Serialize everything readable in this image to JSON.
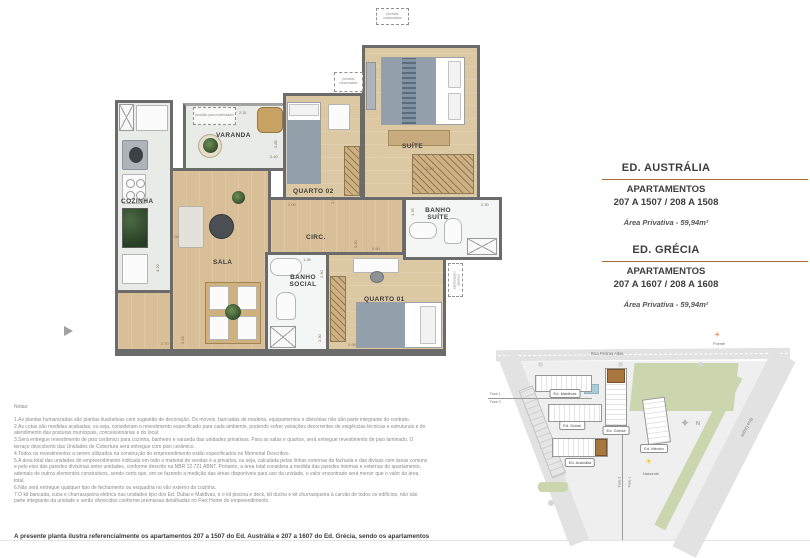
{
  "panel": {
    "sections": [
      {
        "building": "ED. AUSTRÁLIA",
        "apts_label": "APARTAMENTOS",
        "apts_range": "207 A 1507 / 208 A 1508",
        "area": "Área Privativa - 59,94m²"
      },
      {
        "building": "ED. GRÉCIA",
        "apts_label": "APARTAMENTOS",
        "apts_range": "207 A 1607 / 208 A 1608",
        "area": "Área Privativa - 59,94m²"
      }
    ]
  },
  "plan": {
    "rooms": {
      "cozinha": "COZINHA",
      "varanda": "VARANDA",
      "quarto02": "QUARTO 02",
      "suite": "SUÍTE",
      "circ": "CIRC.",
      "sala": "SALA",
      "banho_social": "BANHO SOCIAL",
      "quarto01": "QUARTO 01",
      "banho_suite": "BANHO SUÍTE"
    },
    "condenser_long": "previsão para condensador",
    "condenser_short": "previsão condensador",
    "dims": {
      "varanda_top": "2.31",
      "varanda_right": "0.85",
      "varanda_bottom": "2.40",
      "cozinha_top": "1.50",
      "cozinha_left": "4.20",
      "sala_bottom": "2.70",
      "sala_left": "5.93",
      "quarto02_bottom": "2.00",
      "quarto02_right": "2.95",
      "suite_bottom": "2.40",
      "circ_a": "0.90",
      "circ_b": "0.90",
      "banho_social_top": "1.35",
      "banho_social_right": "2.30",
      "banho_social_bottom": "2.30",
      "quarto01_bottom": "2.95",
      "banho_suite_left": "1.35",
      "banho_suite_top": "2.30"
    }
  },
  "siteplan": {
    "street_top": "Rua Pedras Altas",
    "street_left": "Av. Dom Helder Câmara",
    "street_right": "Rua Degas",
    "buildings": {
      "maldivas": "Ed. Maldivas",
      "dubai": "Ed. Dubai",
      "grecia": "Ed. Grécia",
      "mexico": "Ed. México",
      "australia": "Ed. Austrália"
    },
    "compass": "N",
    "sun_east_label": "Nascente",
    "sun_west_label": "Poente",
    "phase1": "Fase 1",
    "phase2": "Fase 2",
    "colors": {
      "highlight": "#a8763f",
      "green": "#ccd6ae",
      "rule_brown": "#a86a38",
      "sun_east": "#f2c71d",
      "sun_west": "#e2803a"
    }
  },
  "notes": {
    "title": "Notas:",
    "items": [
      "1.As plantas humanizadas são plantas ilustrativas com sugestão de decoração. Os móveis, bancadas de madeira, equipamentos e divisórias não são parte integrante do contrato.",
      "2.As cotas são medidas acabadas, ou seja, consideram o revestimento especificado para cada ambiente, podendo sofrer variações decorrentes de exigências técnicas e estruturais e do atendimento das posturas municipais, concessionárias e do local.",
      "3.Será entregue revestimento de piso cerâmico para cozinha, banheiro e varanda das unidades privativas. Para as salas e quartos, será entregue revestimento de piso laminado. O terraço descoberto das Unidades de Cobertura será entregue com piso cerâmico.",
      "4.Todos os revestimentos a serem utilizados na construção do empreendimento estão especificados no Memorial Descritivo.",
      "5.A área total das unidades do empreendimento indicada em todo o material de vendas é a privativa, ou seja, calculada pelas linhas externas da fachada e das divisas com áreas comuns e pelo eixo das paredes divisórias entre unidades, conforme descrito na NBR 12.721 ABNT. Portanto, a área total considera a medida das paredes internas e externas do apartamento, ademais de outros elementos construtivos, sendo certo que, em se fazendo a medição das áreas disponíveis para uso da unidade, o valor encontrado será menor que o valor da área total.",
      "6.Não será entregue qualquer tipo de fechamento ou esquadria no vão externo da cozinha.",
      "7.O kit bancada, cuba e churrasqueira elétrica nas unidades tipo dos Ed. Dubai e Maldivas, e o kit piscina e deck, kit ducha e kit churrasqueira à carvão de todos os edifícios, não são parte integrante da unidade e serão oferecidos conforme premissas detalhadas no Flex Home do empreendimento."
    ],
    "footer": "A presente planta ilustra referencialmente os apartamentos 207 a 1507 do Ed. Austrália e 207 a 1607 do Ed. Grécia, sendo os apartamentos"
  }
}
